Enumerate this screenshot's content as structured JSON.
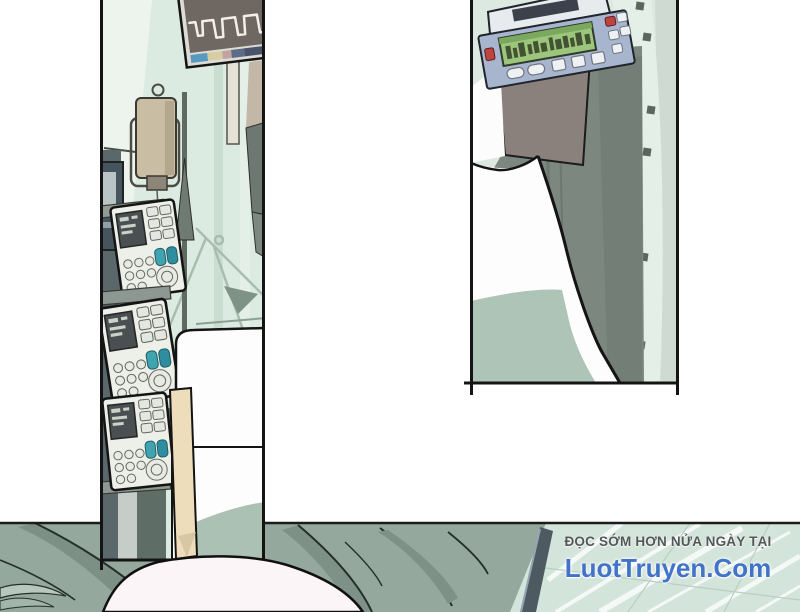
{
  "credit": {
    "tagline": "ĐỌC SỚM HƠN NỬA NGÀY TẠI",
    "site": "LuotTruyen.Com",
    "tagline_color": "#53575a",
    "site_color": "#4273c8"
  },
  "palette": {
    "page_bg": "#ffffff",
    "panel_border": "#141414",
    "curtain": "#dcebe2",
    "curtain_light": "#edf4ee",
    "monitor_screen": "#6f6761",
    "monitor_frame": "#dcdcd5",
    "iv_bottle": "#c9bda3",
    "pump_body": "#edefe9",
    "pump_key_teal_1": "#3fa3b0",
    "pump_key_teal_2": "#2f8da0",
    "bed_white": "#fdfdfd",
    "bed_blanket_beige": "#eeddbb",
    "bed_blanket_green": "#aac1b3",
    "right_pump_blue": "#a8b5ce",
    "right_pump_lcd": "#9cc67b",
    "right_pump_red_key": "#bf4440",
    "equipment_gray": "#7b877f",
    "wall_mint": "#dce9e0",
    "floor_blanket_gray": "#95a89d",
    "mint_backdrop": "#d3e4da",
    "head_skin": "#fcf5f8"
  },
  "scene": {
    "left_panel_objects": [
      "ecg-monitor",
      "iv-bottle",
      "iv-pole",
      "infusion-pumps",
      "hospital-bed"
    ],
    "right_panel_objects": [
      "syringe-pump",
      "equipment-stand",
      "bed-pillow"
    ],
    "foreground_objects": [
      "patient-head",
      "gray-blanket"
    ]
  }
}
